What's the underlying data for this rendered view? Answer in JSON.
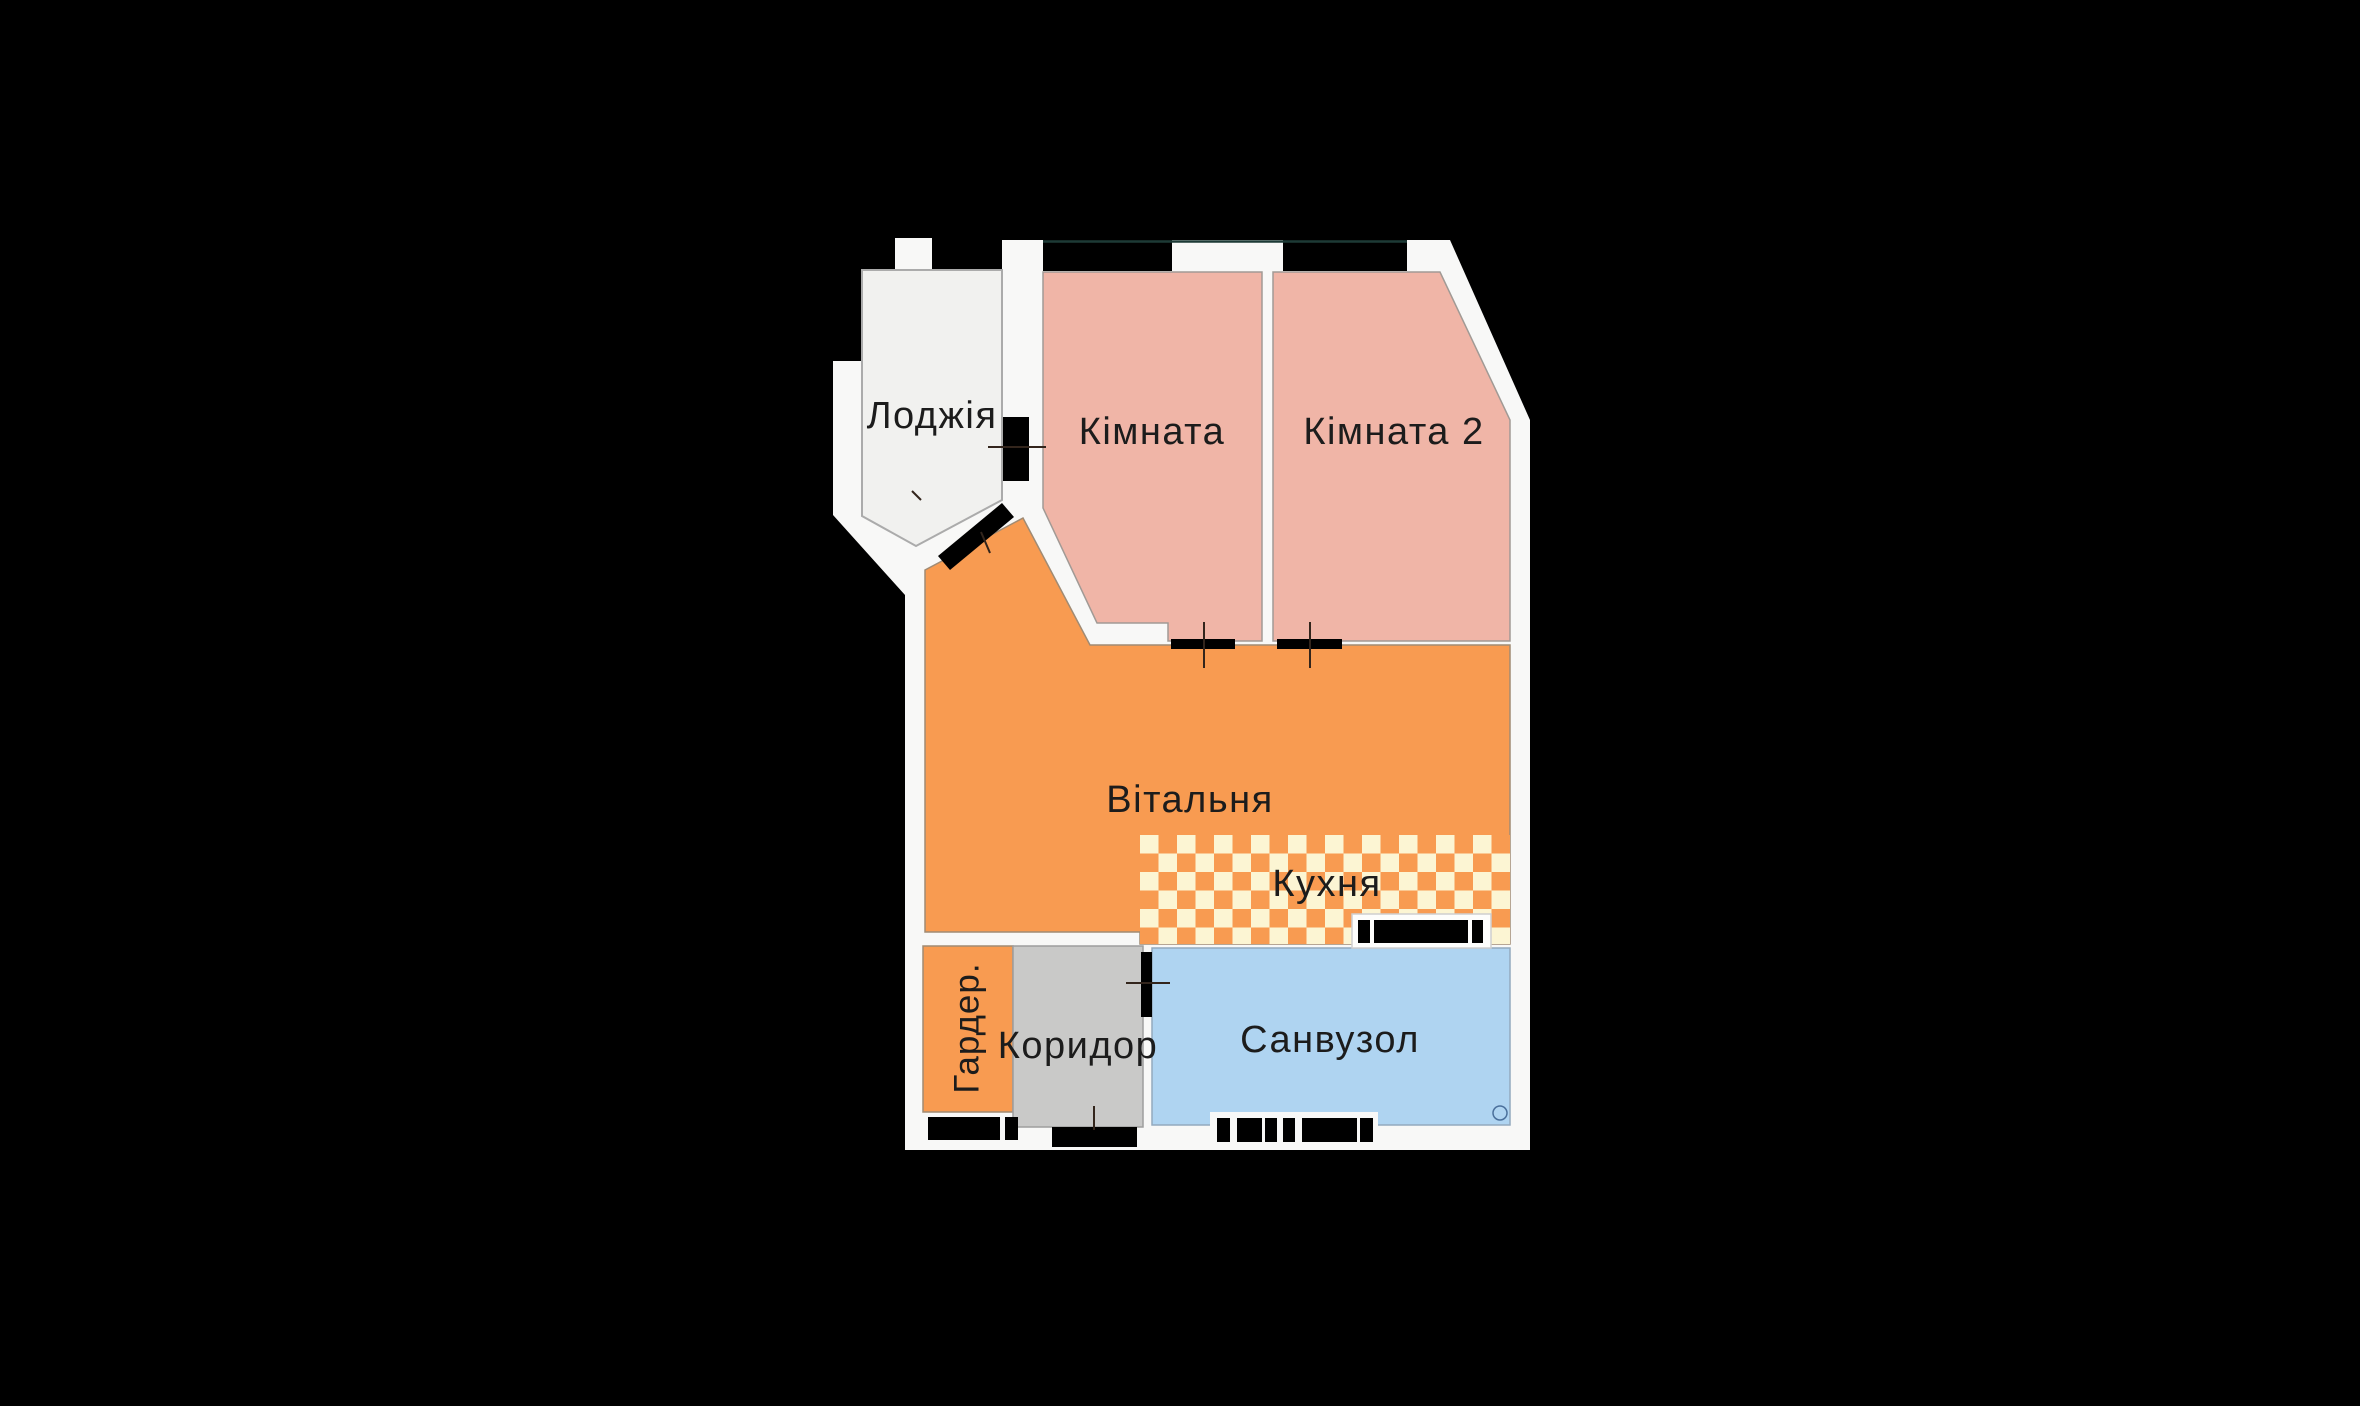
{
  "plan": {
    "rooms": {
      "loggia": {
        "label": "Лоджія"
      },
      "room1": {
        "label": "Кімната"
      },
      "room2": {
        "label": "Кімната 2"
      },
      "living": {
        "label": "Вітальня"
      },
      "kitchen": {
        "label": "Кухня"
      },
      "wardrobe": {
        "label": "Гардер."
      },
      "corridor": {
        "label": "Коридор"
      },
      "bathroom": {
        "label": "Санвузол"
      }
    },
    "colors": {
      "background": "#000000",
      "wall_white": "#F8F8F7",
      "loggia_fill": "#F1F1EF",
      "bedroom_fill": "#F0B5A7",
      "living_fill": "#F89B51",
      "kitchen_check_light": "#FCF5D3",
      "kitchen_check_dark": "#F89B51",
      "corridor_fill": "#C9C9C8",
      "bathroom_fill": "#AFD4F1",
      "feature_black": "#000000",
      "text": "#1C1C1C"
    }
  }
}
